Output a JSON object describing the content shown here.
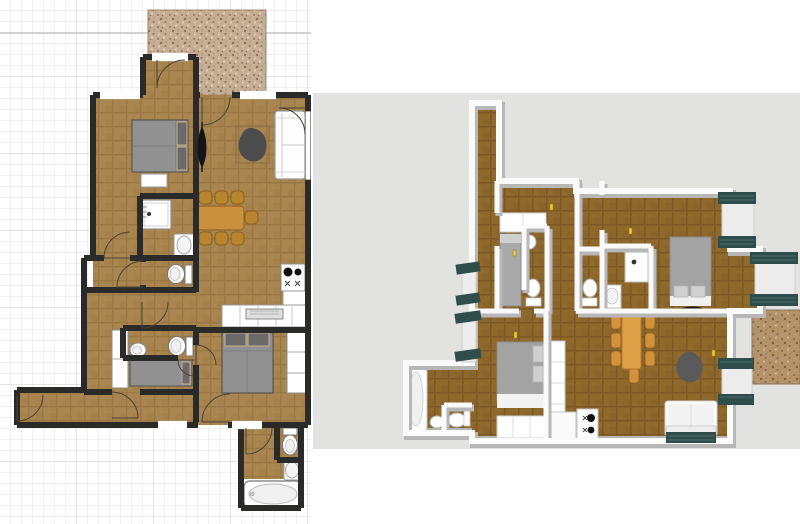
{
  "app": {
    "name": "Home plan editor",
    "description": "2D floor plan beside 3D aerial preview of the same apartment"
  },
  "panels": {
    "plan2d": {
      "label": "2D floor plan canvas"
    },
    "view3d": {
      "label": "3D aerial view canvas"
    }
  },
  "rooms": [
    {
      "name": "terrace"
    },
    {
      "name": "bedroom-1"
    },
    {
      "name": "living-room"
    },
    {
      "name": "kitchen"
    },
    {
      "name": "shower-room"
    },
    {
      "name": "wc-1"
    },
    {
      "name": "hall"
    },
    {
      "name": "wc-2"
    },
    {
      "name": "bedroom-2"
    },
    {
      "name": "corridor"
    },
    {
      "name": "bedroom-3"
    },
    {
      "name": "bathroom"
    }
  ],
  "furniture": [
    {
      "name": "double-bed-1"
    },
    {
      "name": "double-bed-3"
    },
    {
      "name": "single-bed-2"
    },
    {
      "name": "sofa"
    },
    {
      "name": "beanbag-armchair"
    },
    {
      "name": "dining-table"
    },
    {
      "name": "dining-chairs",
      "count": 7
    },
    {
      "name": "shower"
    },
    {
      "name": "washbasin-shower-room"
    },
    {
      "name": "toilet-wc-1"
    },
    {
      "name": "toilet-wc-2"
    },
    {
      "name": "bidet"
    },
    {
      "name": "toilet-bathroom"
    },
    {
      "name": "washbasin-bathroom"
    },
    {
      "name": "bathtub"
    },
    {
      "name": "cooktop"
    },
    {
      "name": "kitchen-counter"
    },
    {
      "name": "wardrobe-bedroom-2"
    },
    {
      "name": "wardrobe-bedroom-3"
    },
    {
      "name": "dresser-bedroom-1"
    },
    {
      "name": "plant-black"
    },
    {
      "name": "window-shutters",
      "count": 6
    }
  ],
  "colors": {
    "wood2d_base": "#a9864f",
    "wood2d_line": "#9a7843",
    "wood3d_base": "#8f692c",
    "wood3d_line": "#7d5a24",
    "terrace_base": "#c6ae95",
    "terrace_speckle_dark": "#9b7f64",
    "terrace_speckle_light": "#e7dac6",
    "grid_fine": "#e3e3e3",
    "grid_heavy": "#c8c8c8",
    "wall_edge": "#2a2a28",
    "wall_fill": "#f7f4ee",
    "wall_stipple": "#b5ab9c",
    "bg_3d": "#e2e2e1",
    "wall3d_side": "#b7b7b7",
    "wall3d_top": "#fafafa",
    "shutter_teal": "#2f4d4b",
    "shutter_line": "#486e6b",
    "bed_grey": "#919191",
    "bed3d_grey": "#a3a3a3",
    "pillow_dark": "#6a6a6a",
    "pillow_edge": "#c9b189",
    "pillow3d": "#d0d0d0",
    "table_2d": "#c9913e",
    "chair_2d": "#b8852f",
    "chair_edge": "#8a5f1d",
    "table_3d": "#dfa148",
    "chair_3d": "#d2923c",
    "sofa_white": "#fdfdfd",
    "beanbag_2d": "#4d4d4d",
    "beanbag_3d": "#5a5a5a",
    "fixture_stroke": "#8c8c8c",
    "black_item": "#151515",
    "marker_yellow": "#e8cb3d"
  }
}
